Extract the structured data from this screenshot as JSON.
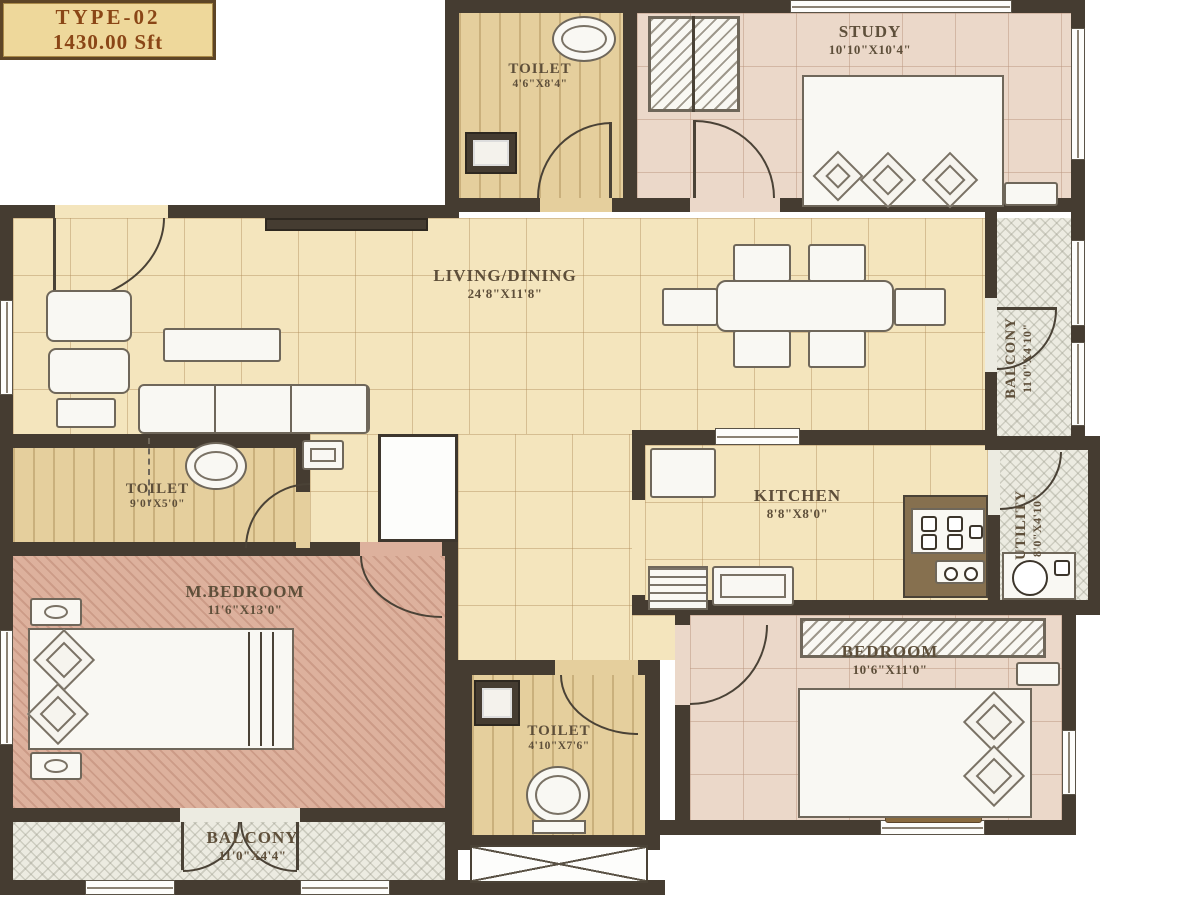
{
  "plan": {
    "title_box": {
      "type": "TYPE-02",
      "area": "1430.00 Sft"
    },
    "rooms": {
      "toilet_top": {
        "name": "TOILET",
        "dims": "4'6\"X8'4\""
      },
      "study": {
        "name": "STUDY",
        "dims": "10'10\"X10'4\""
      },
      "living_dining": {
        "name": "LIVING/DINING",
        "dims": "24'8\"X11'8\""
      },
      "balcony_right": {
        "name": "BALCONY",
        "dims": "11'0\"X4'10\""
      },
      "toilet_left": {
        "name": "TOILET",
        "dims": "9'0\"X5'0\""
      },
      "kitchen": {
        "name": "KITCHEN",
        "dims": "8'8\"X8'0\""
      },
      "utility": {
        "name": "UTILITY",
        "dims": "8'0\"X4'10\""
      },
      "m_bedroom": {
        "name": "M.BEDROOM",
        "dims": "11'6\"X13'0\""
      },
      "bedroom": {
        "name": "BEDROOM",
        "dims": "10'6\"X11'0\""
      },
      "toilet_bottom": {
        "name": "TOILET",
        "dims": "4'10\"X7'6\""
      },
      "balcony_bottom": {
        "name": "BALCONY",
        "dims": "11'0\"X4'4\""
      }
    },
    "colors": {
      "wall": "#453c31",
      "floor_cream": "#f4e5bd",
      "floor_pink": "#ebd8c9",
      "floor_terracotta": "#ddb19d",
      "floor_toilet": "#e5cf9d",
      "floor_balcony": "#ecebe1",
      "label_text": "#5e4f3a",
      "area_box_bg": "#eed89b",
      "area_box_text": "#8a4616"
    }
  }
}
